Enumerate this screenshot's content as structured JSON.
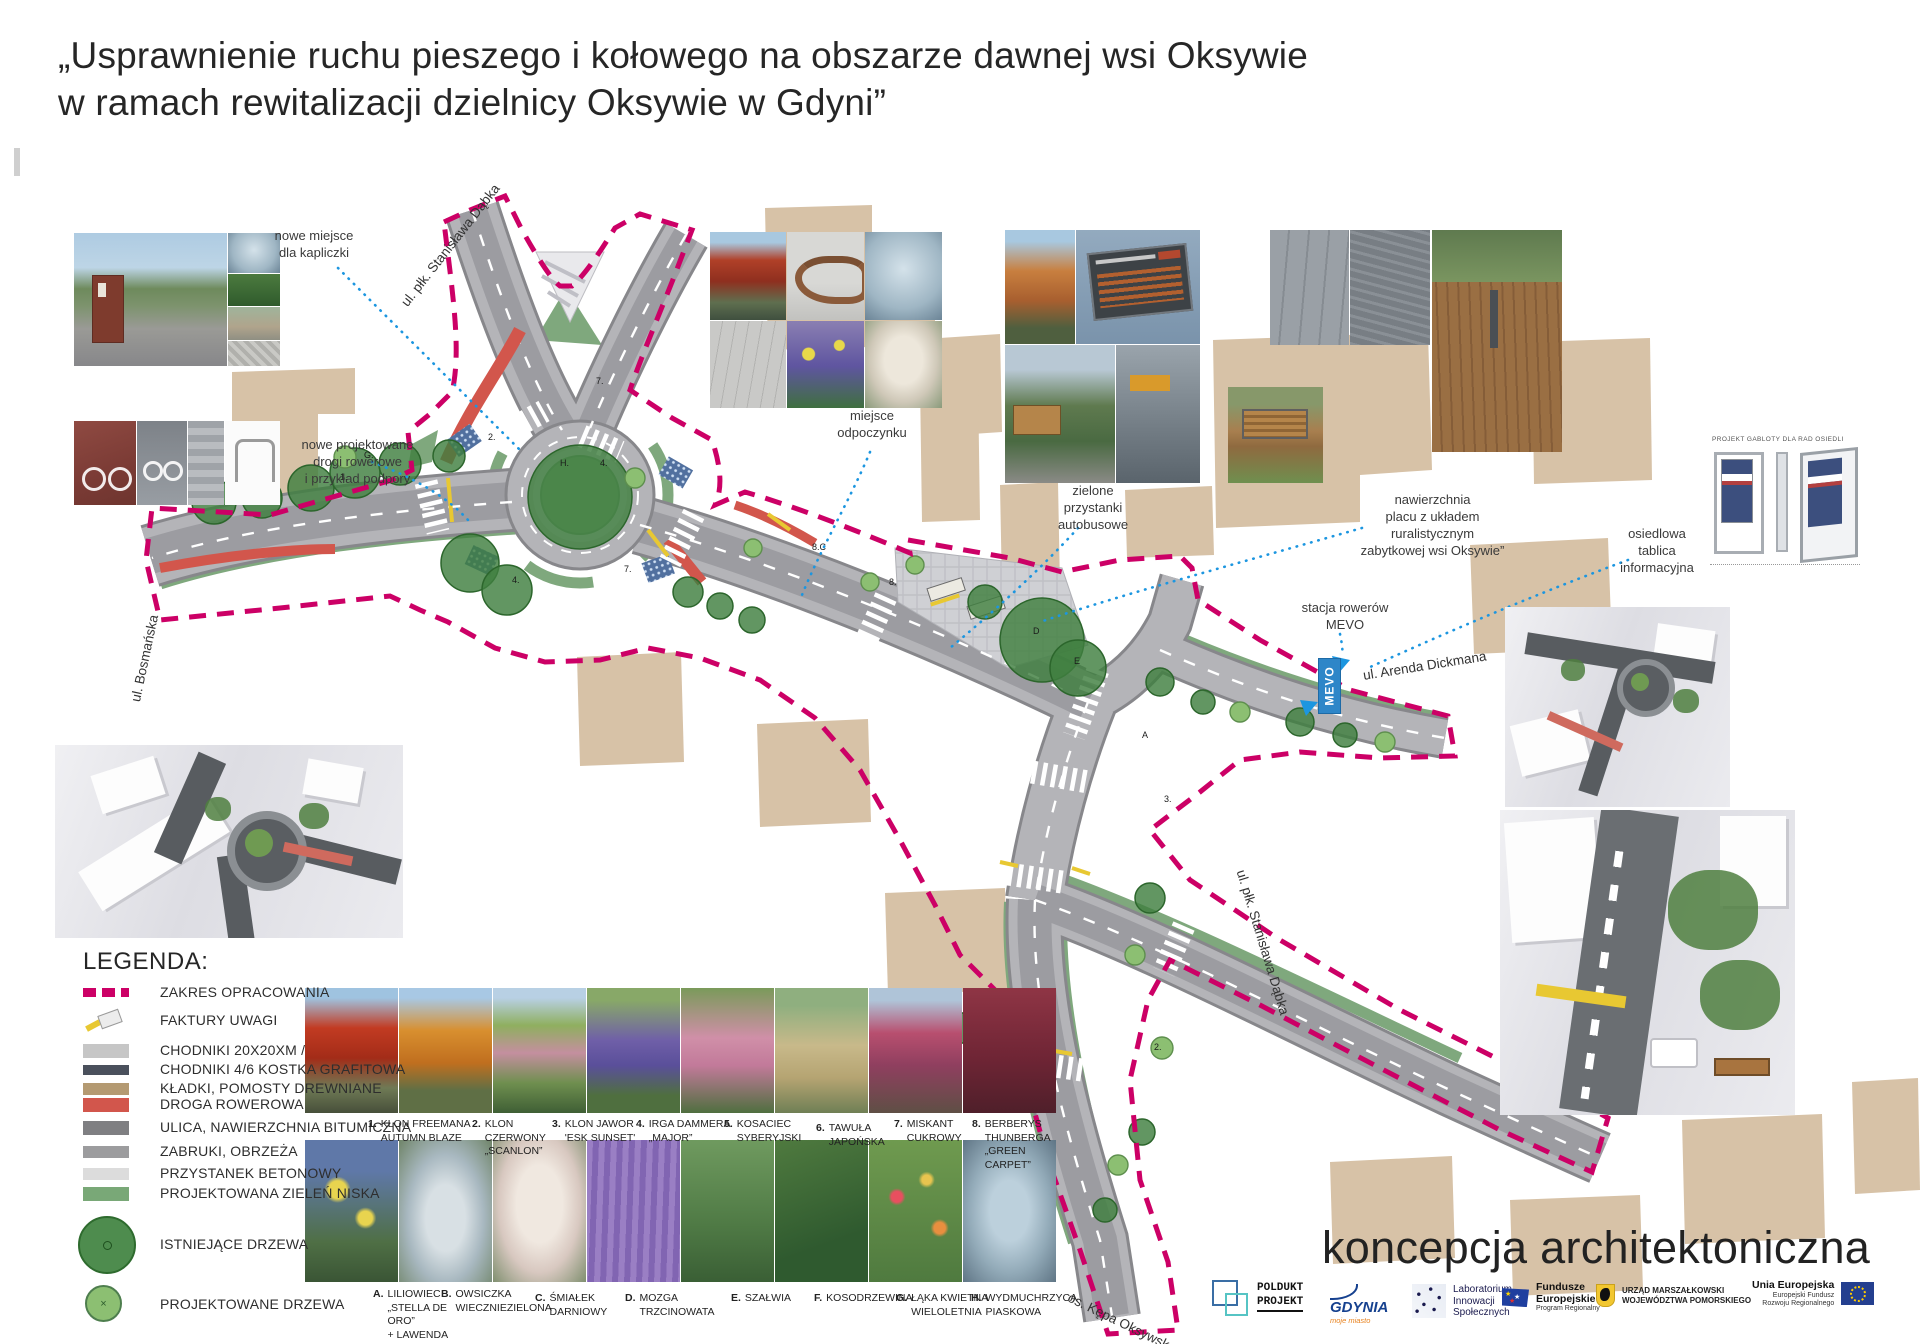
{
  "title": {
    "line1": "„Usprawnienie ruchu pieszego i kołowego na obszarze dawnej wsi Oksywie",
    "line2": "w ramach rewitalizacji dzielnicy Oksywie w Gdyni”"
  },
  "annotations": {
    "kapliczka": "nowe miejsce\ndla kapliczki",
    "drogi_rowerowe": "nowe projektowane\ndrogi rowerowe\ni przykład podpory",
    "odpoczynek": "miejsce\nodpoczynku",
    "przystanki": "zielone\nprzystanki\nautobusowe",
    "nawierzchnia": "nawierzchnia\nplacu z układem\nruralistycznym\nzabytkowej wsi Oksywie”",
    "mevo": "stacja rowerów\nMEVO",
    "tablica": "osiedlowa\ntablica\ninformacyjna"
  },
  "street_labels": {
    "dabka_top": "ul. płk. Stanisława Dąbka",
    "bosmanska": "ul. Bosmańska",
    "dickmana": "ul. Arenda Dickmana",
    "dabka_bottom": "ul. płk. Stanisława Dąbka",
    "kepa": "os. Kępa Oksywska",
    "mevo_box": "MEVO"
  },
  "gablota": {
    "caption": "PROJEKT GABLOTY DLA RAD OSIEDLI"
  },
  "legend": {
    "heading": "LEGENDA:",
    "items": [
      {
        "label": "ZAKRES OPRACOWANIA"
      },
      {
        "label": "FAKTURY UWAGI"
      },
      {
        "label": "CHODNIKI 20X20XM /"
      },
      {
        "label": "CHODNIKI 4/6 KOSTKA GRAFITOWA"
      },
      {
        "label": "KŁADKI, POMOSTY DREWNIANE"
      },
      {
        "label": "DROGA ROWEROWA"
      },
      {
        "label": "ULICA, NAWIERZCHNIA BITUMICZNA"
      },
      {
        "label": "ZABRUKI, OBRZEŻA"
      },
      {
        "label": "PRZYSTANEK BETONOWY"
      },
      {
        "label": "PROJEKTOWANA ZIELEŃ NISKA"
      },
      {
        "label": "ISTNIEJĄCE DRZEWA"
      },
      {
        "label": "PROJEKTOWANE DRZEWA"
      }
    ]
  },
  "plants": {
    "row1": [
      {
        "num": "1.",
        "name": "KLON FREEMANA\nAUTUMN BLAZE"
      },
      {
        "num": "2.",
        "name": "KLON CZERWONY\n„SCANLON”"
      },
      {
        "num": "3.",
        "name": "KLON JAWOR\n'ESK SUNSET'"
      },
      {
        "num": "4.",
        "name": "IRGA DAMMERA\n„MAJOR”"
      },
      {
        "num": "5.",
        "name": "KOSACIEC\nSYBERYJSKI"
      },
      {
        "num": "6.",
        "name": "TAWUŁA\nJAPOŃSKA"
      },
      {
        "num": "7.",
        "name": "MISKANT CUKROWY"
      },
      {
        "num": "8.",
        "name": "BERBERYS\nTHUNBERGA\n„GREEN CARPET”"
      }
    ],
    "row2": [
      {
        "num": "A.",
        "name": "LILIOWIEC\n„STELLA DE ORO”\n+ LAWENDA\nWĄSKOLISTNA"
      },
      {
        "num": "B.",
        "name": "OWSICZKA\nWIECZNIEZIELONA"
      },
      {
        "num": "C.",
        "name": "ŚMIAŁEK\nDARNIOWY"
      },
      {
        "num": "D.",
        "name": "MOZGA TRZCINOWATA"
      },
      {
        "num": "E.",
        "name": "SZAŁWIA"
      },
      {
        "num": "F.",
        "name": "KOSODRZEWINA"
      },
      {
        "num": "G.",
        "name": "ŁĄKA KWIETNA\nWIELOLETNIA"
      },
      {
        "num": "H.",
        "name": "WYDMUCHRZYCA\nPIASKOWA"
      }
    ]
  },
  "plan_markers": [
    {
      "t": "G."
    },
    {
      "t": "H."
    },
    {
      "t": "4."
    },
    {
      "t": "7."
    },
    {
      "t": "2."
    },
    {
      "t": "4."
    },
    {
      "t": "7."
    },
    {
      "t": "8."
    },
    {
      "t": "8.C"
    },
    {
      "t": "1."
    },
    {
      "t": "E"
    },
    {
      "t": "D"
    },
    {
      "t": "A"
    },
    {
      "t": "3."
    },
    {
      "t": "2."
    }
  ],
  "footer": {
    "concept": "koncepcja architektoniczna",
    "logos": {
      "poldukt1": "POLDUKT",
      "poldukt2": "PROJEKT",
      "gdynia": "GDYNIA",
      "gdynia_sub": "moje miasto",
      "lis": "Laboratorium\nInnowacji\nSpołecznych",
      "fe": "Fundusze\nEuropejskie",
      "fe_sub": "Program Regionalny",
      "um": "URZĄD MARSZAŁKOWSKI\nWOJEWÓDZTWA POMORSKIEGO",
      "ue": "Unia Europejska",
      "ue_sub": "Europejski Fundusz\nRozwoju Regionalnego"
    }
  },
  "colors": {
    "boundary": "#cc0066",
    "bike_path": "#d2564c",
    "green_low": "#7fa87d",
    "leader_line": "#1c96e0",
    "road": "#b4b4b8",
    "building_footprint": "#d7c2a7"
  }
}
